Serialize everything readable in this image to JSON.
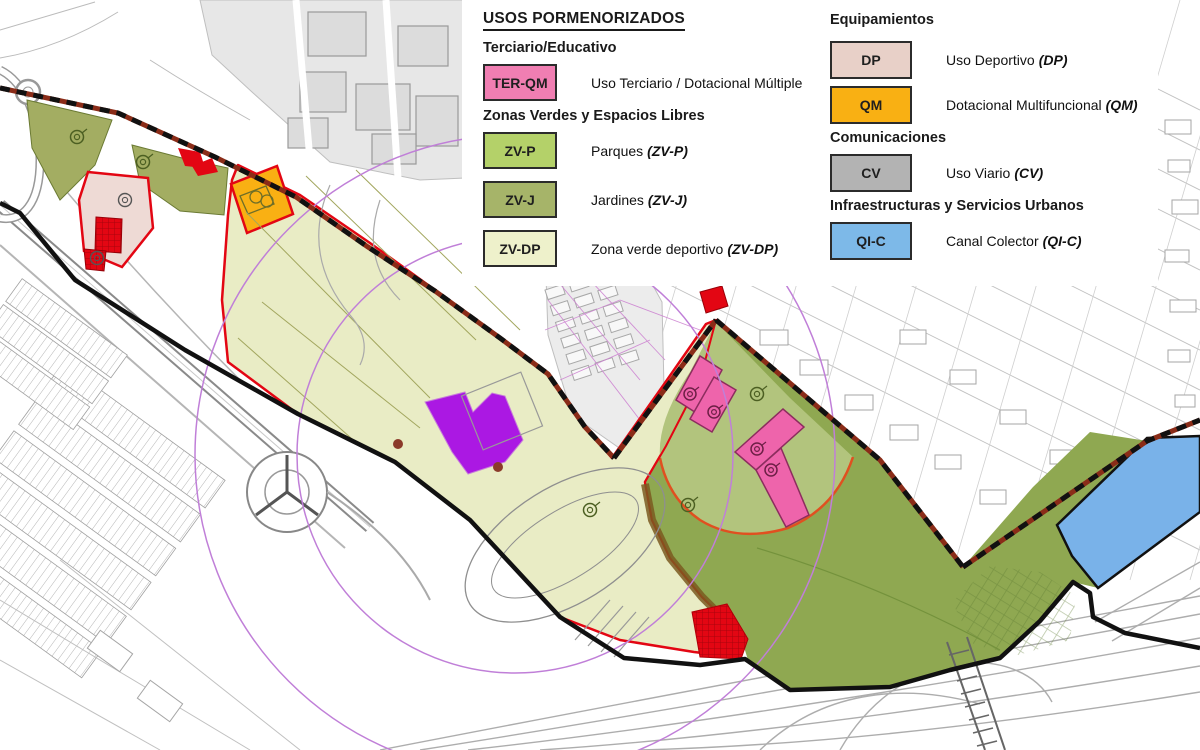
{
  "legend": {
    "left": {
      "title": "USOS PORMENORIZADOS",
      "sections": [
        {
          "heading": "Terciario/Educativo",
          "items": [
            {
              "code": "TER-QM",
              "color": "#f07eb2",
              "text": "Uso Terciario / Dotacional Múltiple",
              "paren": ""
            }
          ]
        },
        {
          "heading": "Zonas Verdes y Espacios Libres",
          "items": [
            {
              "code": "ZV-P",
              "color": "#b4d169",
              "text": "Parques",
              "paren": "(ZV-P)"
            },
            {
              "code": "ZV-J",
              "color": "#a6b469",
              "text": "Jardines",
              "paren": "(ZV-J)"
            },
            {
              "code": "ZV-DP",
              "color": "#eef1cb",
              "text": "Zona verde deportivo",
              "paren": "(ZV-DP)"
            }
          ]
        }
      ]
    },
    "right": {
      "sections": [
        {
          "heading": "Equipamientos",
          "items": [
            {
              "code": "DP",
              "color": "#e8d0c8",
              "text": "Uso Deportivo",
              "paren": "(DP)"
            },
            {
              "code": "QM",
              "color": "#f9b013",
              "text": "Dotacional Multifuncional",
              "paren": "(QM)"
            }
          ]
        },
        {
          "heading": "Comunicaciones",
          "items": [
            {
              "code": "CV",
              "color": "#b3b3b3",
              "text": "Uso Viario",
              "paren": "(CV)"
            }
          ]
        },
        {
          "heading": "Infraestructuras y Servicios Urbanos",
          "items": [
            {
              "code": "QI-C",
              "color": "#7db9e8",
              "text": "Canal Colector",
              "paren": "(QI-C)"
            }
          ]
        }
      ]
    }
  },
  "map": {
    "colors": {
      "pale_zone": "#e9ecc5",
      "olive_zone": "#a3ad62",
      "green_zone": "#8fa851",
      "green_light_zone": "#b2c47d",
      "pink_zone": "#ee64ab",
      "dp_zone": "#eedad5",
      "qm_zone": "#f9b013",
      "canal_zone": "#79b2e9",
      "purple_zone": "#ab18e3",
      "red_zone": "#e30613",
      "outline_red": "#e30613",
      "boundary_red": "#8a2c18",
      "boundary_black": "#111111",
      "circle_purple": "#c07fd8"
    }
  }
}
